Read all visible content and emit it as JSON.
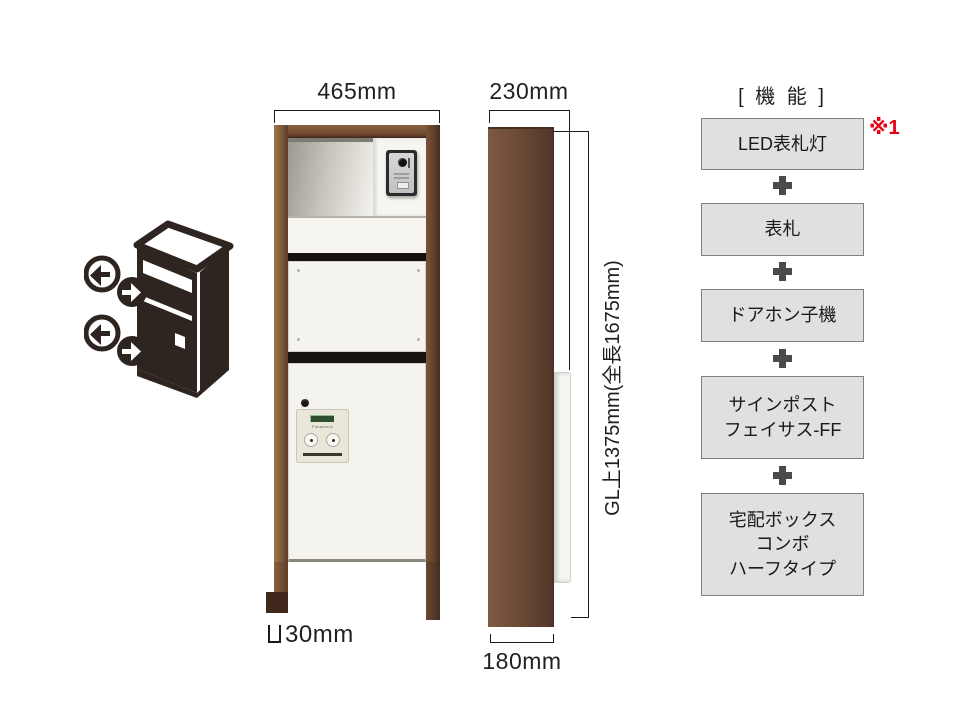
{
  "diagram_title": "post-unit-specification-diagram",
  "dims": {
    "width": "465mm",
    "depth": "230mm",
    "leg": "30mm",
    "base": "180mm",
    "height": "GL上1375mm(全長1675mm)"
  },
  "features": {
    "header": "[ 機 能 ]",
    "note": "※1",
    "items": [
      {
        "label": "LED表札灯"
      },
      {
        "label": "表札"
      },
      {
        "label": "ドアホン子機"
      },
      {
        "label": "サインポスト\nフェイサス-FF"
      },
      {
        "label": "宅配ボックス\nコンボ\nハーフタイプ"
      }
    ]
  },
  "front_view": {
    "panel_brand": "Panasonic"
  },
  "icons": {
    "pictogram": "access-direction-pictogram-icon",
    "leg_symbol": "leg-profile-symbol"
  },
  "colors": {
    "frame_brown": "#6e4a33",
    "accent_red": "#e60012",
    "feature_box_bg": "#e0e0e0",
    "pictogram_dark": "#2e2420"
  }
}
